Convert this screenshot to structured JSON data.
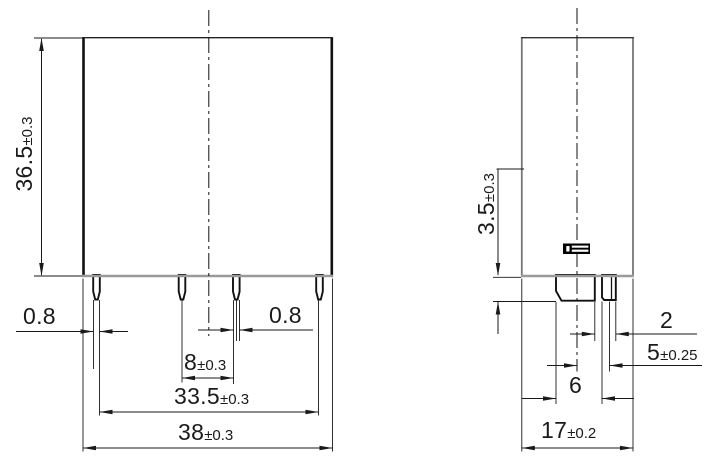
{
  "dims": {
    "front_height": {
      "value": "36.5",
      "tol": "±0.3"
    },
    "front_pin_width_left": {
      "value": "0.8",
      "tol": ""
    },
    "front_pin_width_right": {
      "value": "0.8",
      "tol": ""
    },
    "front_pin_pitch": {
      "value": "8",
      "tol": "±0.3"
    },
    "front_pin_span": {
      "value": "33.5",
      "tol": "±0.3"
    },
    "front_overall_width": {
      "value": "38",
      "tol": "±0.3"
    },
    "side_pin_seat_height": {
      "value": "3.5",
      "tol": "±0.3"
    },
    "side_pin_offset": {
      "value": "2",
      "tol": ""
    },
    "side_pin_spacing": {
      "value": "5",
      "tol": "±0.25"
    },
    "side_blade_pin_width": {
      "value": "6",
      "tol": ""
    },
    "side_overall_depth": {
      "value": "17",
      "tol": "±0.2"
    }
  }
}
